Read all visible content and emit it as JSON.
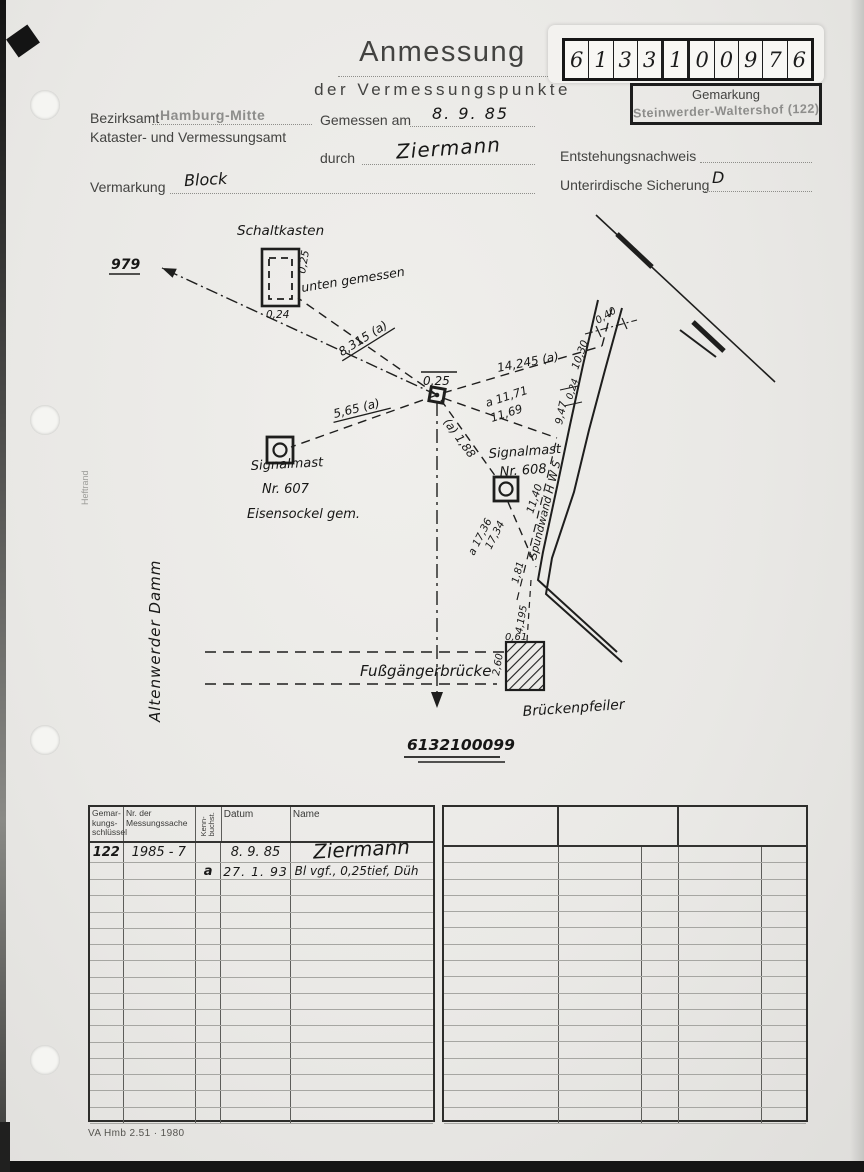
{
  "page": {
    "title": "Anmessung",
    "subtitle": "der Vermessungspunkte",
    "footer": "VA Hmb 2.51 · 1980"
  },
  "ident": {
    "digits": [
      "6",
      "1",
      "3",
      "3",
      "1",
      "0",
      "0",
      "9",
      "7",
      "6"
    ],
    "gemarkung_label": "Gemarkung",
    "gemarkung_value": "Steinwerder-Waltershof (122)"
  },
  "form": {
    "bezirksamt_label": "Bezirksamt",
    "bezirksamt_value": "Hamburg-Mitte",
    "amt_label": "Kataster- und Vermessungsamt",
    "gemessen_label": "Gemessen am",
    "gemessen_value": "8. 9. 85",
    "durch_label": "durch",
    "durch_value": "Ziermann",
    "entstehung_label": "Entstehungsnachweis",
    "entstehung_value": "",
    "vermarkung_label": "Vermarkung",
    "vermarkung_value": "Block",
    "sicherung_label": "Unterirdische Sicherung",
    "sicherung_value": "D"
  },
  "margin": {
    "heftrand": "Heftrand",
    "street": "Altenwerder Damm"
  },
  "sketch": {
    "point_label": "0,25",
    "target_point": "979",
    "target_number": "6132100099",
    "schaltkasten": {
      "label": "Schaltkasten",
      "note": "unten gemessen",
      "width": "0,24",
      "depth": "0,25"
    },
    "mast607": {
      "l1": "Signalmast",
      "l2": "Nr. 607",
      "l3": "Eisensockel gem."
    },
    "mast608": {
      "l1": "Signalmast",
      "l2": "Nr. 608"
    },
    "spundwand": "Spundwand  H W S",
    "bridge": {
      "label": "Fußgängerbrücke",
      "pier": "Brückenpfeiler",
      "pier_width": "0,61",
      "pier_height": "2,60"
    },
    "measures": {
      "d_schaltkasten": "8,315 (a)",
      "d_mast607": "5,65 (a)",
      "d_wall_top": "14,245 (a)",
      "d_10_30": "10,30",
      "d_0_40": "0,40",
      "d_0_24": "0,24",
      "d_9_47": "9,47",
      "d_11_71": "a 11,71",
      "d_11_69": "11,69",
      "d_1_88": "(a) 1,88",
      "d_11_40": "11,40",
      "d_17_36": "a 17,36",
      "d_17_34": "17,34",
      "d_1_81": "1,81",
      "d_4_195": "4,195"
    }
  },
  "table": {
    "headers": {
      "gemarkung": "Gemar-\nkungs-\nschlüssel",
      "messungssache": "Nr. der\nMessungssache",
      "kennbuchst": "Kenn-\nbuchst.",
      "datum": "Datum",
      "name": "Name"
    },
    "rows": [
      {
        "gemarkung": "122",
        "messungssache": "1985 - 7",
        "kennbuchst": "",
        "datum": "8. 9. 85",
        "name": "Ziermann"
      },
      {
        "gemarkung": "",
        "messungssache": "",
        "kennbuchst": "a",
        "datum": "27. 1. 93",
        "name": "Bl  vgf., 0,25tief, Düh"
      }
    ]
  }
}
